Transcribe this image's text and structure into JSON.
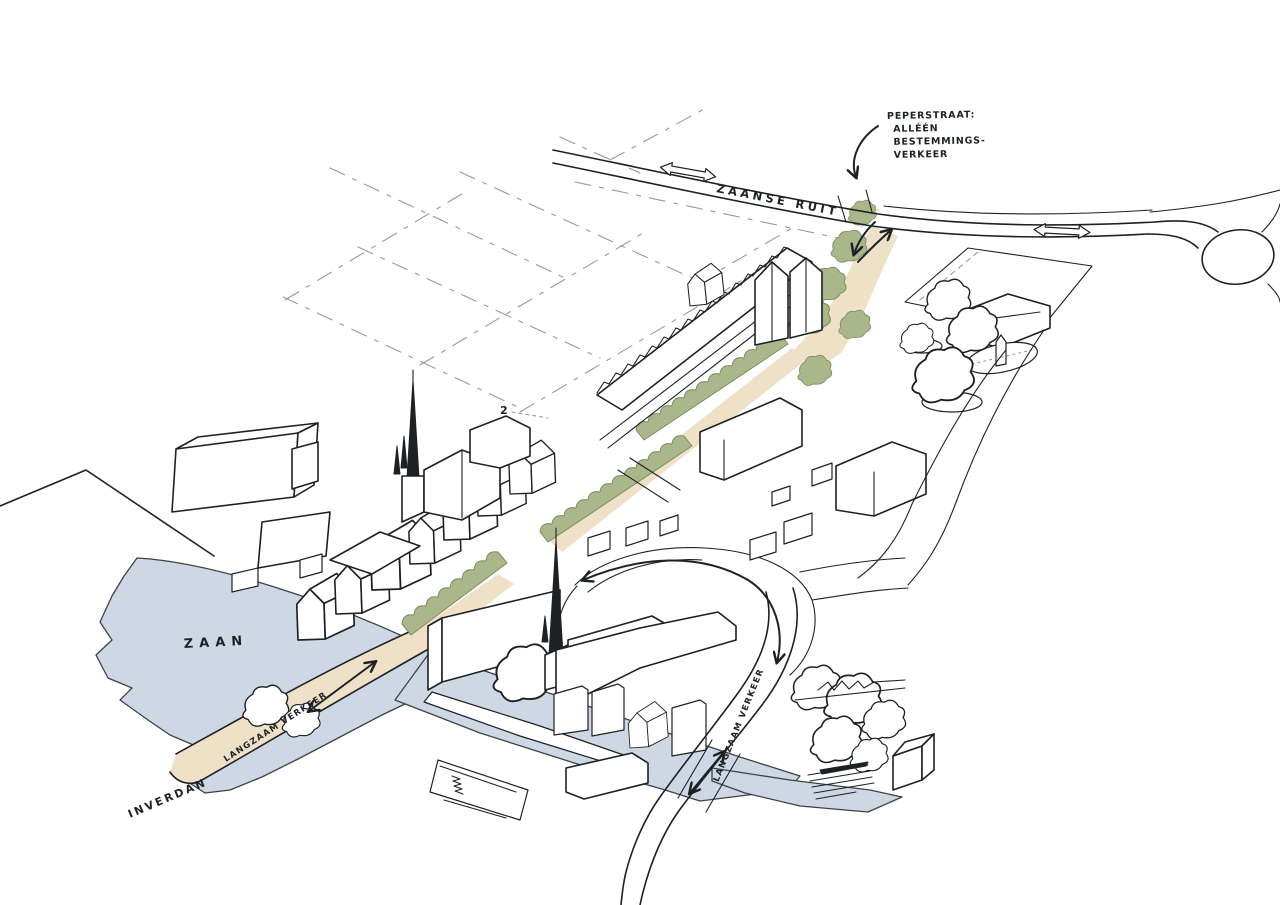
{
  "colors": {
    "paper": "#ffffff",
    "ink": "#1e2124",
    "faint": "#999999",
    "water": "#cdd8e4",
    "shore": "#3c4248",
    "route": "#eee1c8",
    "green": "#a9b78b",
    "green_edge": "#7c8c5f"
  },
  "map": {
    "region_labels": {
      "zaan": "ZAAN",
      "inverdan": "INVERDAN"
    },
    "road_labels": {
      "zaanse_ruit": "ZAANSE RUIT",
      "langzaam_verkeer_bridge": "LANGZAAM VERKEER",
      "langzaam_verkeer_east": "LANGZAAM VERKEER"
    },
    "annotation": {
      "lines": [
        "PEPERSTRAAT:",
        "ALLÉÉN",
        "BESTEMMINGS-",
        "VERKEER"
      ]
    },
    "notes": {
      "floors": "2"
    },
    "icons": {
      "west_road_arrow": "two-way-road-arrow",
      "east_road_arrow": "two-way-road-arrow",
      "annotation_arrow": "curved-pointer-arrow",
      "peperstraat_arrows": "two-way-street-arrows",
      "bridge_arrow": "two-way-slow-traffic-arrow",
      "plaza_arrow": "loop-road-arrow",
      "southeast_arrow": "two-way-slow-traffic-arrow"
    }
  }
}
